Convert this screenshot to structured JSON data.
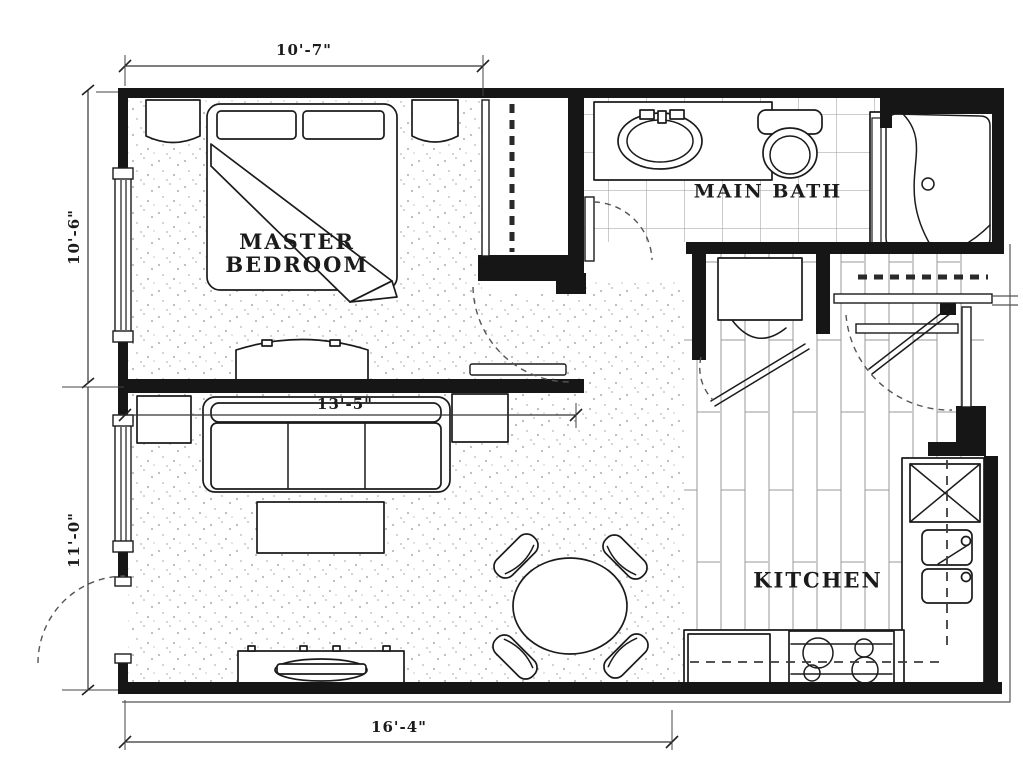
{
  "rooms": {
    "master_bedroom": {
      "line1": "MASTER",
      "line2": "BEDROOM"
    },
    "main_bath": {
      "label": "MAIN BATH"
    },
    "kitchen": {
      "label": "KITCHEN"
    }
  },
  "dimensions": {
    "bedroom_width_top": "10'-7\"",
    "bedroom_depth_left_upper": "10'-6\"",
    "living_depth_left_lower": "11'-0\"",
    "living_width_middle": "13'-5\"",
    "overall_width_bottom": "16'-4\""
  },
  "fixtures": [
    "bed",
    "pillows",
    "nightstand-left",
    "nightstand-right",
    "dresser",
    "closet-rod",
    "sofa",
    "end-table-left",
    "end-table-right",
    "coffee-table",
    "tv-console",
    "dining-table",
    "dining-chairs",
    "vanity-sink",
    "toilet",
    "shower",
    "washer",
    "kitchen-sink-double",
    "refrigerator",
    "stove-4-burner",
    "counter"
  ],
  "colors": {
    "background": "#ffffff",
    "wall": "#161616",
    "line": "#1b1b1b",
    "dash": "#555555"
  }
}
